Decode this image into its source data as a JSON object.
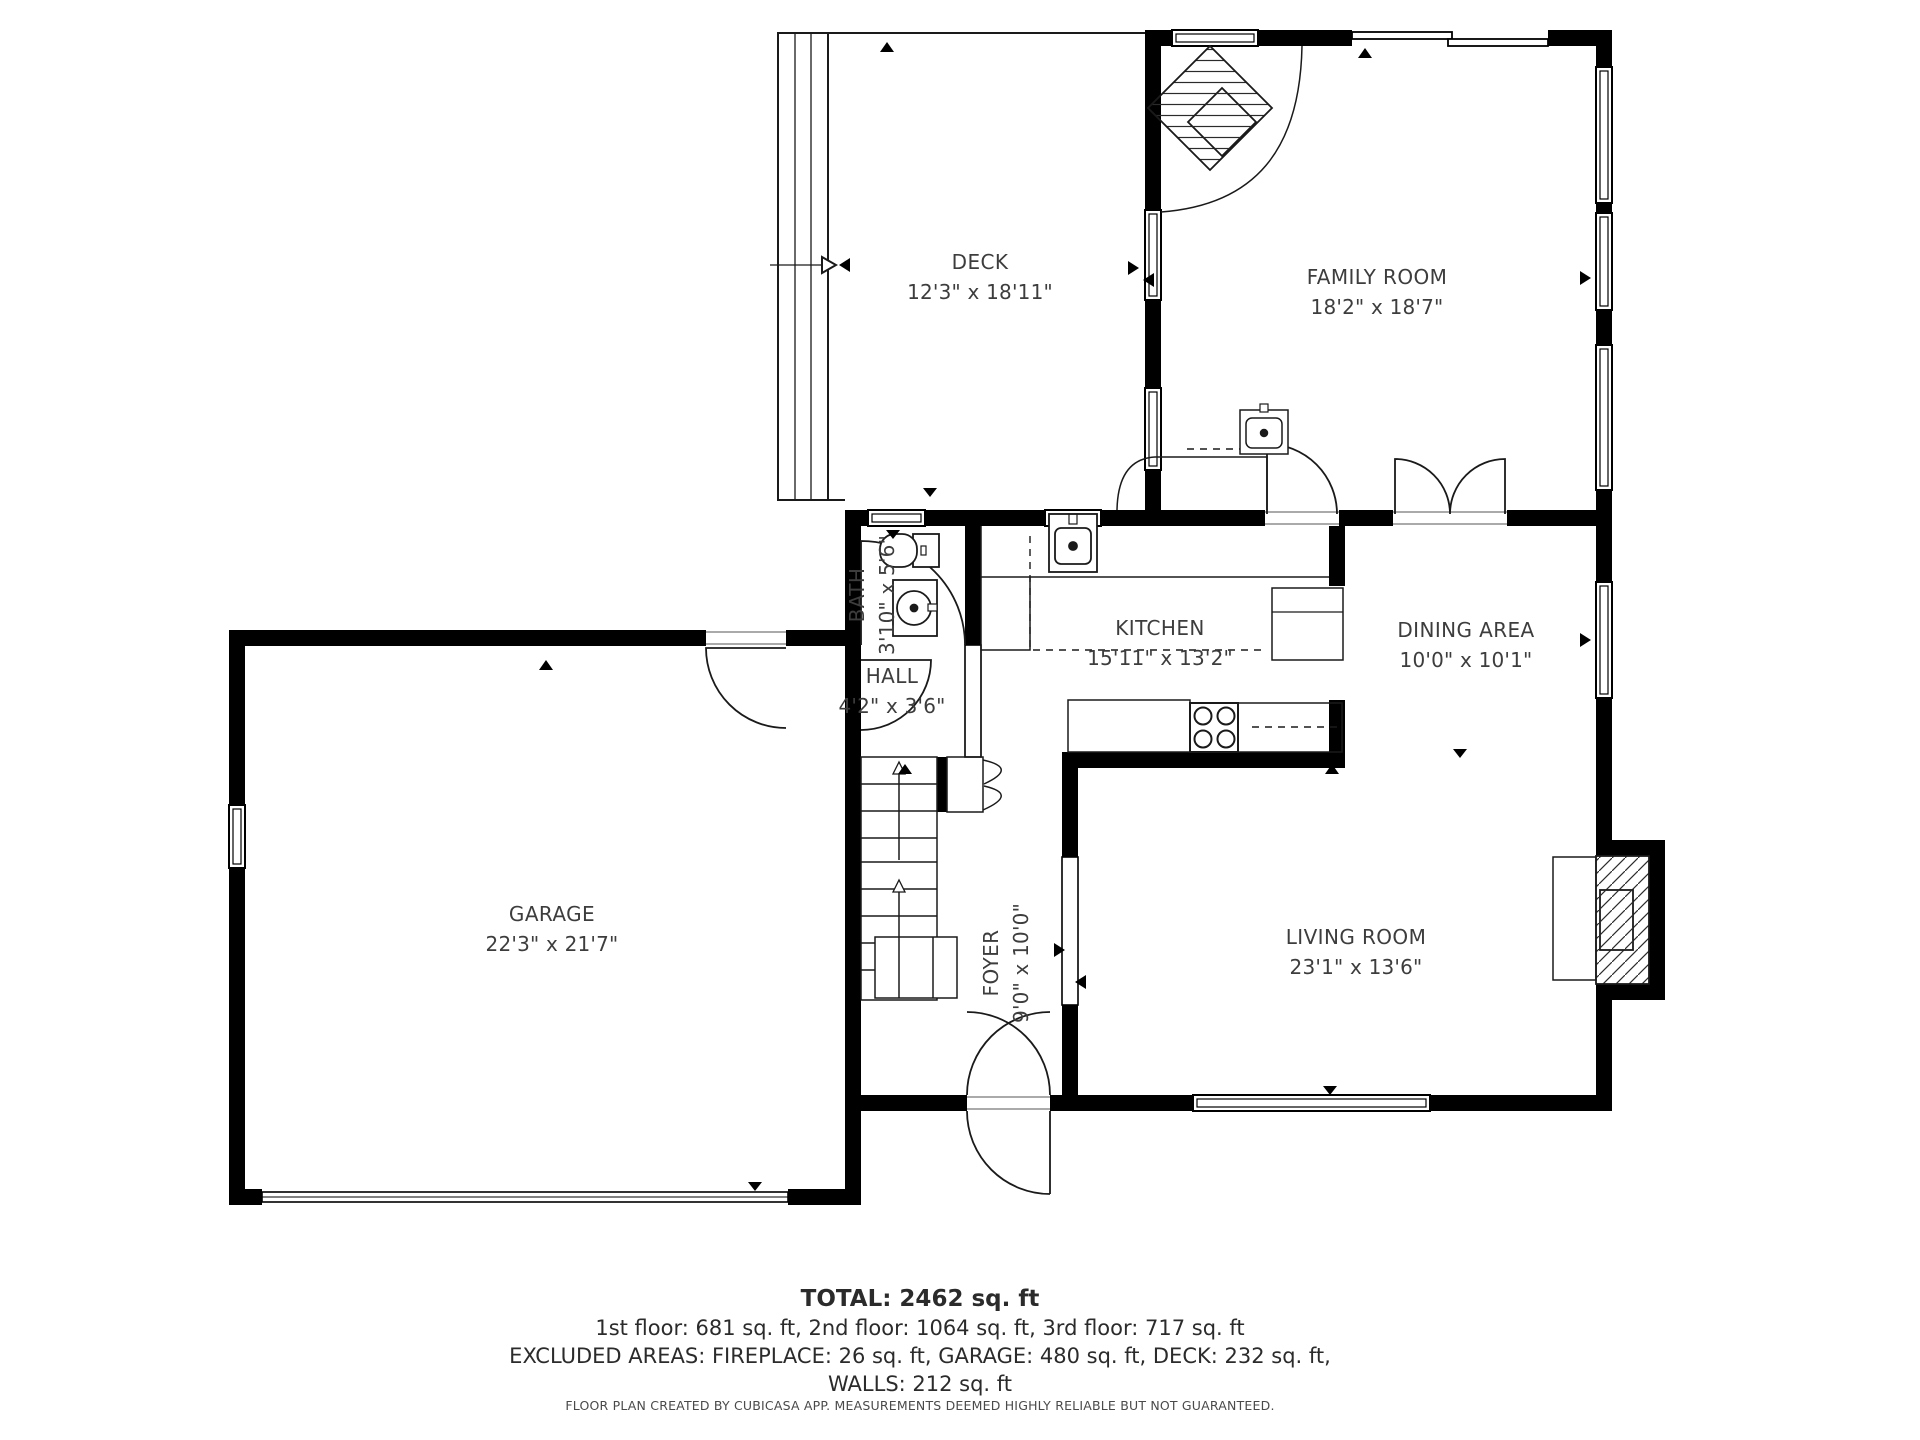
{
  "rooms": [
    {
      "name": "DECK",
      "dims": "12'3\" x 18'11\""
    },
    {
      "name": "FAMILY ROOM",
      "dims": "18'2\" x 18'7\""
    },
    {
      "name": "BATH",
      "dims": "3'10\" x 5'6\""
    },
    {
      "name": "KITCHEN",
      "dims": "15'11\" x 13'2\""
    },
    {
      "name": "DINING AREA",
      "dims": "10'0\" x 10'1\""
    },
    {
      "name": "HALL",
      "dims": "4'2\" x 3'6\""
    },
    {
      "name": "GARAGE",
      "dims": "22'3\" x 21'7\""
    },
    {
      "name": "FOYER",
      "dims": "9'0\" x 10'0\""
    },
    {
      "name": "LIVING ROOM",
      "dims": "23'1\" x 13'6\""
    }
  ],
  "summary": {
    "total": "TOTAL: 2462 sq. ft",
    "floors": "1st floor: 681 sq. ft, 2nd floor: 1064 sq. ft, 3rd floor: 717 sq. ft",
    "excluded": "EXCLUDED AREAS: FIREPLACE: 26 sq. ft, GARAGE: 480 sq. ft, DECK: 232 sq. ft,",
    "walls": "WALLS: 212 sq. ft",
    "disclaimer": "FLOOR PLAN CREATED BY CUBICASA APP. MEASUREMENTS DEEMED HIGHLY RELIABLE BUT NOT GUARANTEED."
  },
  "colors": {
    "wall": "#000000",
    "line": "#1a1a1a",
    "text": "#3d3d3d",
    "background": "#ffffff"
  }
}
